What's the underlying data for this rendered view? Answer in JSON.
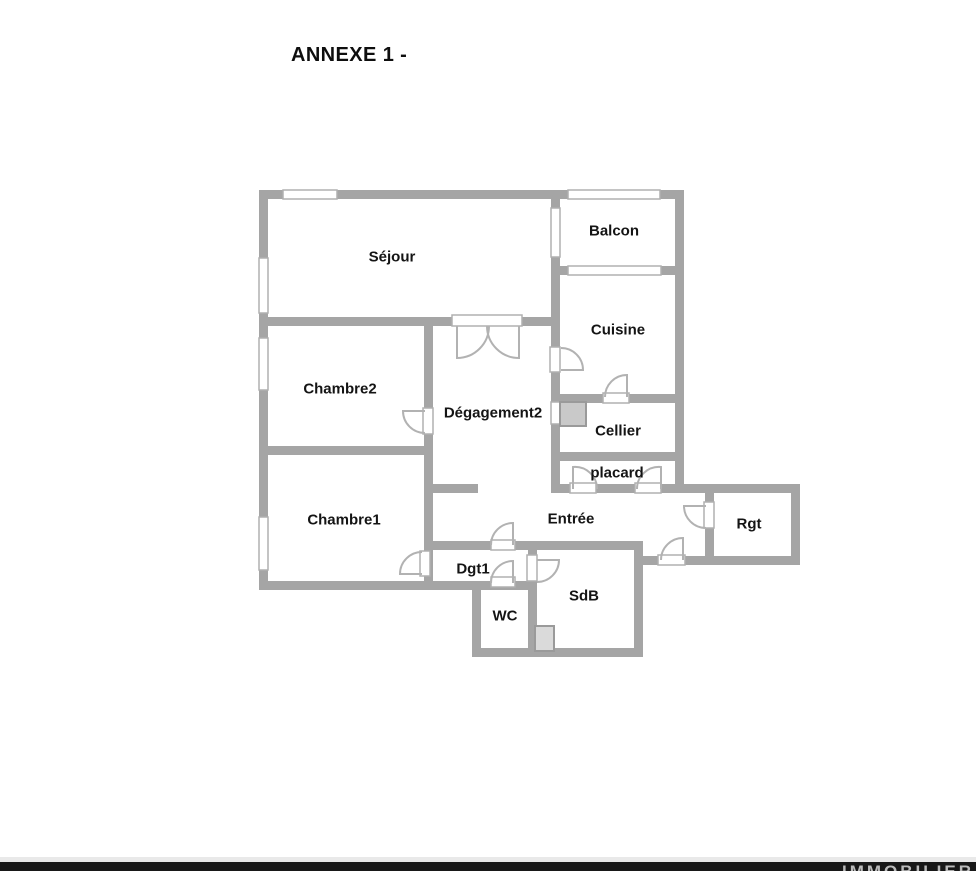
{
  "title": {
    "text": "ANNEXE 1 -"
  },
  "watermark": {
    "text": "IMMOBILIER"
  },
  "colors": {
    "wall": "#a5a5a5",
    "door": "#b2b2b2",
    "window_border": "#b0b0b0",
    "appliance_border": "#9a9a9a",
    "label": "#141414"
  },
  "plan": {
    "rooms": [
      {
        "id": "sejour",
        "label": "Séjour",
        "x": 392,
        "y": 257
      },
      {
        "id": "balcon",
        "label": "Balcon",
        "x": 614,
        "y": 231
      },
      {
        "id": "cuisine",
        "label": "Cuisine",
        "x": 618,
        "y": 330
      },
      {
        "id": "chambre2",
        "label": "Chambre2",
        "x": 340,
        "y": 389
      },
      {
        "id": "degagement2",
        "label": "Dégagement2",
        "x": 493,
        "y": 413
      },
      {
        "id": "cellier",
        "label": "Cellier",
        "x": 618,
        "y": 431
      },
      {
        "id": "placard",
        "label": "placard",
        "x": 617,
        "y": 473
      },
      {
        "id": "chambre1",
        "label": "Chambre1",
        "x": 344,
        "y": 520
      },
      {
        "id": "entree",
        "label": "Entrée",
        "x": 571,
        "y": 519
      },
      {
        "id": "rgt",
        "label": "Rgt",
        "x": 749,
        "y": 524
      },
      {
        "id": "dgt1",
        "label": "Dgt1",
        "x": 473,
        "y": 569
      },
      {
        "id": "sdb",
        "label": "SdB",
        "x": 584,
        "y": 596
      },
      {
        "id": "wc",
        "label": "WC",
        "x": 505,
        "y": 616
      }
    ],
    "walls": [
      [
        259,
        190,
        425,
        9
      ],
      [
        552,
        266,
        132,
        9
      ],
      [
        259,
        317,
        301,
        9
      ],
      [
        259,
        446,
        174,
        9
      ],
      [
        552,
        394,
        132,
        9
      ],
      [
        552,
        452,
        132,
        9
      ],
      [
        552,
        484,
        248,
        9
      ],
      [
        433,
        484,
        45,
        9
      ],
      [
        643,
        556,
        157,
        9
      ],
      [
        424,
        541,
        219,
        9
      ],
      [
        259,
        581,
        278,
        9
      ],
      [
        472,
        648,
        171,
        9
      ],
      [
        259,
        190,
        9,
        400
      ],
      [
        424,
        317,
        9,
        273
      ],
      [
        551,
        190,
        9,
        303
      ],
      [
        675,
        190,
        9,
        303
      ],
      [
        705,
        493,
        9,
        72
      ],
      [
        791,
        484,
        9,
        81
      ],
      [
        634,
        541,
        9,
        116
      ],
      [
        528,
        541,
        9,
        116
      ],
      [
        472,
        581,
        9,
        76
      ]
    ],
    "windows": [
      [
        283,
        190,
        54,
        9
      ],
      [
        568,
        190,
        92,
        9
      ],
      [
        259,
        258,
        9,
        55
      ],
      [
        259,
        338,
        9,
        52
      ],
      [
        259,
        517,
        9,
        53
      ],
      [
        551,
        208,
        9,
        49
      ],
      [
        568,
        266,
        93,
        9
      ],
      [
        551,
        402,
        9,
        22
      ]
    ],
    "door_frames": [
      [
        452,
        315,
        70,
        11
      ],
      [
        423,
        408,
        10,
        26
      ],
      [
        420,
        551,
        10,
        25
      ],
      [
        550,
        347,
        10,
        25
      ],
      [
        603,
        393,
        26,
        10
      ],
      [
        570,
        483,
        26,
        10
      ],
      [
        635,
        483,
        26,
        10
      ],
      [
        704,
        502,
        10,
        26
      ],
      [
        658,
        555,
        27,
        10
      ],
      [
        491,
        540,
        24,
        10
      ],
      [
        491,
        577,
        24,
        10
      ],
      [
        527,
        555,
        10,
        26
      ]
    ],
    "doors": [
      {
        "id": "double-door-left",
        "hinge": [
          457,
          326
        ],
        "leaf": [
          457,
          358
        ],
        "end": [
          489,
          326
        ],
        "sweep": 0
      },
      {
        "id": "double-door-right",
        "hinge": [
          519,
          326
        ],
        "leaf": [
          519,
          358
        ],
        "end": [
          487,
          326
        ],
        "sweep": 1
      },
      {
        "id": "chambre2-door",
        "hinge": [
          425,
          411
        ],
        "leaf": [
          403,
          411
        ],
        "end": [
          425,
          433
        ],
        "sweep": 0
      },
      {
        "id": "chambre1-door",
        "hinge": [
          422,
          574
        ],
        "leaf": [
          400,
          574
        ],
        "end": [
          422,
          552
        ],
        "sweep": 1
      },
      {
        "id": "cuisine-door",
        "hinge": [
          561,
          370
        ],
        "leaf": [
          583,
          370
        ],
        "end": [
          561,
          348
        ],
        "sweep": 0
      },
      {
        "id": "cellier-door",
        "hinge": [
          627,
          397
        ],
        "leaf": [
          627,
          375
        ],
        "end": [
          605,
          397
        ],
        "sweep": 0
      },
      {
        "id": "placard-door-left",
        "hinge": [
          573,
          489
        ],
        "leaf": [
          573,
          467
        ],
        "end": [
          597,
          489
        ],
        "sweep": 1
      },
      {
        "id": "placard-door-right",
        "hinge": [
          661,
          489
        ],
        "leaf": [
          661,
          467
        ],
        "end": [
          637,
          489
        ],
        "sweep": 0
      },
      {
        "id": "rgt-door",
        "hinge": [
          706,
          506
        ],
        "leaf": [
          684,
          506
        ],
        "end": [
          706,
          528
        ],
        "sweep": 0
      },
      {
        "id": "entrance-door",
        "hinge": [
          683,
          560
        ],
        "leaf": [
          683,
          538
        ],
        "end": [
          661,
          560
        ],
        "sweep": 0
      },
      {
        "id": "dgt1-door",
        "hinge": [
          513,
          545
        ],
        "leaf": [
          513,
          523
        ],
        "end": [
          491,
          545
        ],
        "sweep": 0
      },
      {
        "id": "wc-door",
        "hinge": [
          513,
          583
        ],
        "leaf": [
          513,
          561
        ],
        "end": [
          491,
          583
        ],
        "sweep": 0
      },
      {
        "id": "sdb-door",
        "hinge": [
          537,
          560
        ],
        "leaf": [
          559,
          560
        ],
        "end": [
          537,
          582
        ],
        "sweep": 1
      }
    ],
    "appliances": [
      {
        "name": "cellier-appliance",
        "x": 560,
        "y": 402,
        "w": 26,
        "h": 24,
        "fill": "#c9c9c9"
      },
      {
        "name": "sdb-fixture",
        "x": 535,
        "y": 626,
        "w": 19,
        "h": 25,
        "fill": "#dadada"
      }
    ]
  }
}
